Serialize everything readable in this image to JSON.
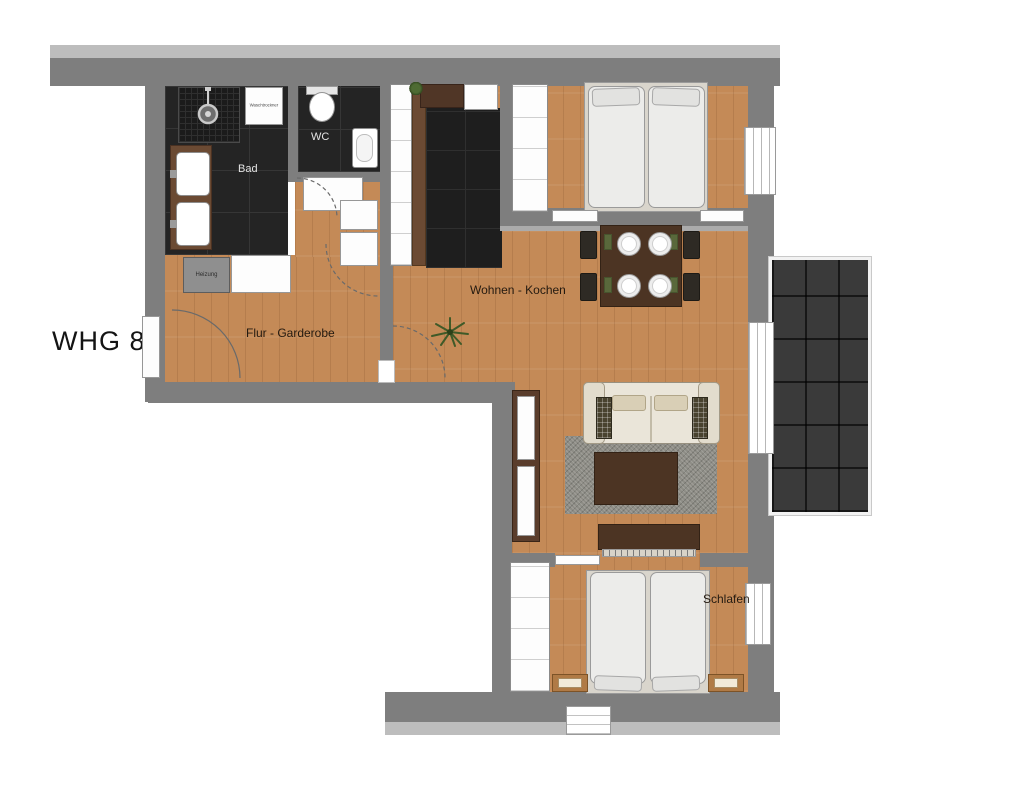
{
  "title": "WHG 8",
  "rooms": {
    "bad": "Bad",
    "wc": "WC",
    "flur_garderobe": "Flur - Garderobe",
    "wohnen_kochen": "Wohnen - Kochen",
    "schlafen": "Schlafen"
  },
  "fixtures": {
    "heizung": "Heizung",
    "waschtrockner": "Waschtrockner"
  },
  "colors": {
    "wall": "#7e7e7e",
    "wall_light": "#bdbdbd",
    "wood_floor": "#c48a57",
    "dark_tile": "#242424",
    "balcony_tile": "#3a3a3a",
    "dark_wood_furniture": "#4c3423",
    "sofa": "#eae5d9",
    "rug": "#8e8d86"
  }
}
